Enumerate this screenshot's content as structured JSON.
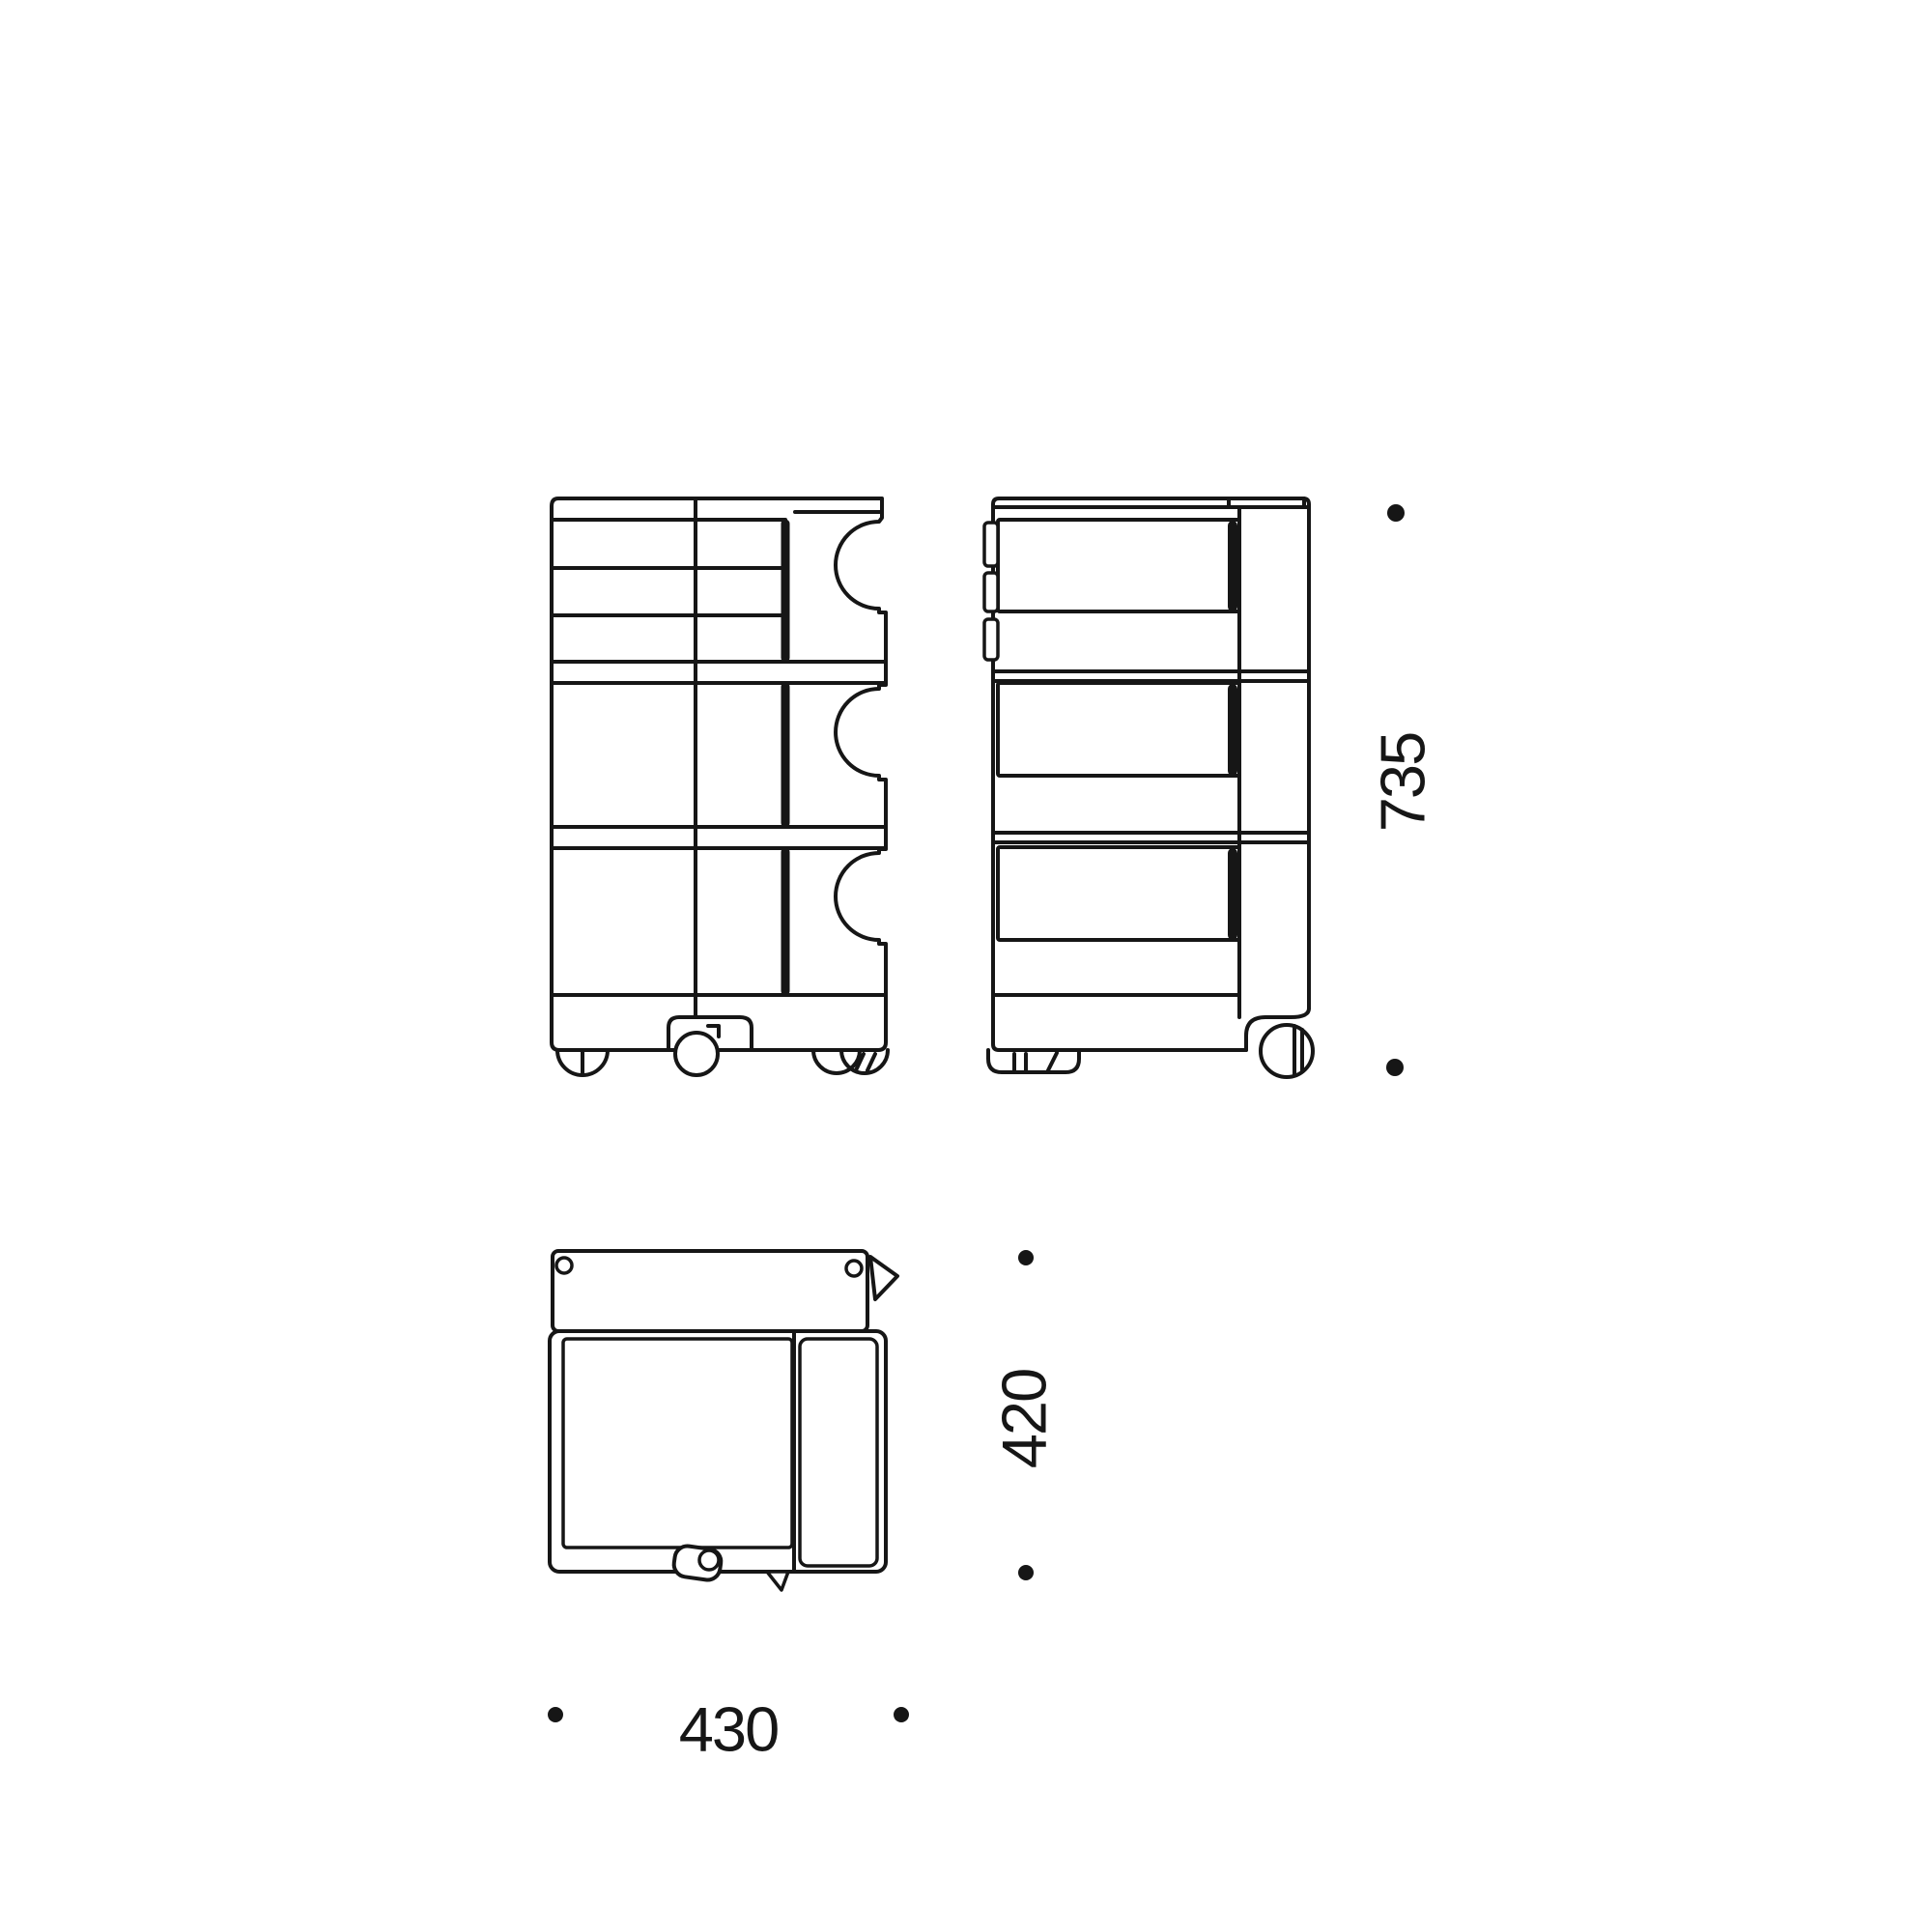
{
  "canvas": {
    "background": "#ffffff",
    "line_color": "#161616"
  },
  "drawing": {
    "kind": "three-view technical line drawing of a wheeled drawer trolley",
    "views": [
      {
        "id": "front-view",
        "position": "top-left"
      },
      {
        "id": "side-view",
        "position": "top-right"
      },
      {
        "id": "top-view",
        "position": "bottom-left"
      }
    ],
    "labels": {
      "height": "735",
      "depth": "420",
      "width": "430"
    },
    "dimension_markers": {
      "shape": "dot",
      "count": 6
    }
  }
}
